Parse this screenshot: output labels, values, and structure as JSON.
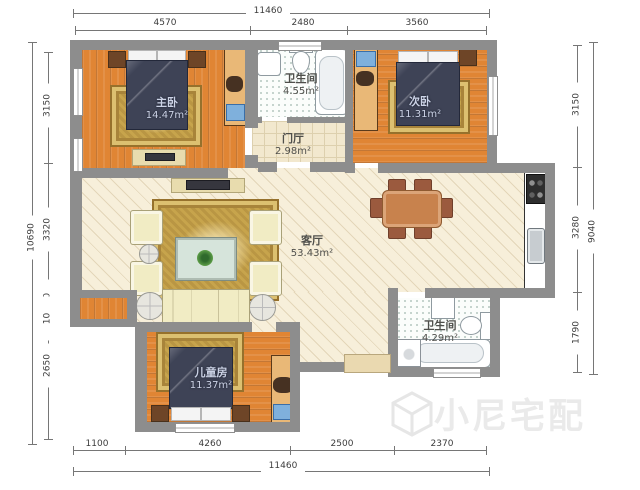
{
  "plan": {
    "type": "apartment-floor-plan",
    "unit": "mm"
  },
  "dimensions": {
    "top": {
      "total": "11460",
      "segments": [
        "4570",
        "2480",
        "3560"
      ]
    },
    "bottom": {
      "total": "11460",
      "segments": [
        "1100",
        "4260",
        "2500",
        "2370"
      ]
    },
    "left": {
      "total": "10690",
      "segments": [
        "3150",
        "3320",
        "510",
        "10",
        "2650"
      ]
    },
    "right": {
      "total": "9040",
      "segments": [
        "3150",
        "3280",
        "1790"
      ]
    }
  },
  "rooms": [
    {
      "name": "主卧",
      "area": "14.47m²"
    },
    {
      "name": "卫生间",
      "area": "4.55m²"
    },
    {
      "name": "次卧",
      "area": "11.31m²"
    },
    {
      "name": "门厅",
      "area": "2.98m²"
    },
    {
      "name": "客厅",
      "area": "53.43m²"
    },
    {
      "name": "卫生间",
      "area": "4.29m²"
    },
    {
      "name": "儿童房",
      "area": "11.37m²"
    }
  ],
  "watermark": {
    "brand": "小尼宅配"
  },
  "colors": {
    "wall": "#8d8d8d",
    "wood_floor": "#e08534",
    "living_floor": "#f7efda",
    "rug": "#c7a44c",
    "bedding": "#3e4356",
    "watermark": "#eaeaea"
  }
}
